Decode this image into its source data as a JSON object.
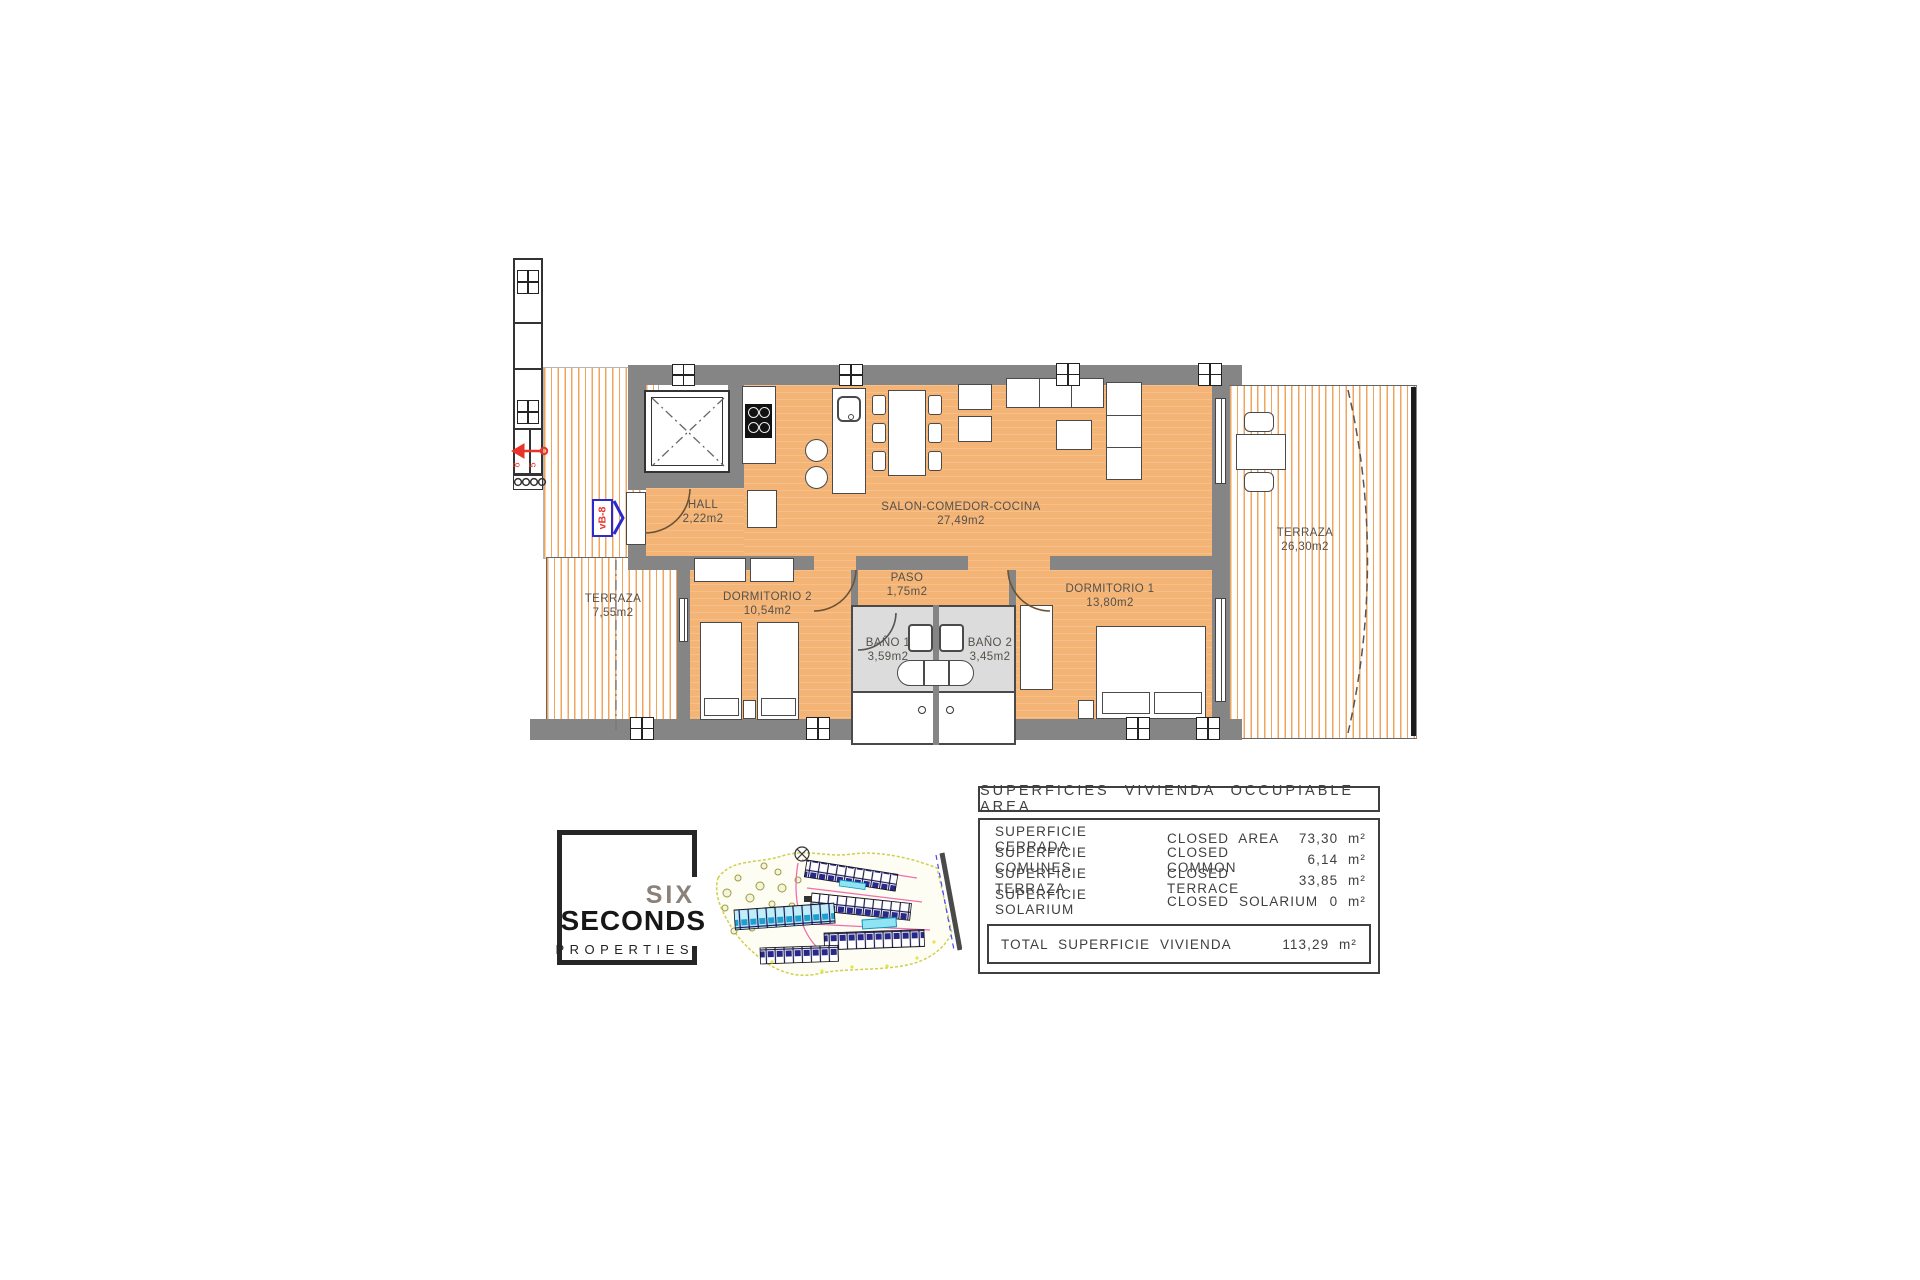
{
  "floor_plan": {
    "unit_label": "vB-8",
    "entrance_marks": {
      "left": "8",
      "right": "5"
    },
    "rooms": {
      "hall": {
        "name": "HALL",
        "area": "2,22m2"
      },
      "salon": {
        "name": "SALON-COMEDOR-COCINA",
        "area": "27,49m2"
      },
      "paso": {
        "name": "PASO",
        "area": "1,75m2"
      },
      "dormitorio2": {
        "name": "DORMITORIO 2",
        "area": "10,54m2"
      },
      "dormitorio1": {
        "name": "DORMITORIO 1",
        "area": "13,80m2"
      },
      "bano1": {
        "name": "BAÑO 1",
        "area": "3,59m2"
      },
      "bano2": {
        "name": "BAÑO 2",
        "area": "3,45m2"
      },
      "terraza_izq": {
        "name": "TERRAZA",
        "area": "7,55m2"
      },
      "terraza_der": {
        "name": "TERRAZA",
        "area": "26,30m2"
      }
    },
    "colors": {
      "floor": "#f4b476",
      "wall": "#858585",
      "bath_floor": "#dcdcdc",
      "terrace_stripe": "#efa55c",
      "annotation_red": "#e8322a",
      "annotation_blue": "#2a2ad0"
    }
  },
  "areas_table": {
    "title": "SUPERFICIES VIVIENDA OCCUPIABLE AREA",
    "rows": [
      {
        "label_es": "SUPERFICIE CERRADA",
        "label_en": "CLOSED AREA",
        "value": "73,30 m²"
      },
      {
        "label_es": "SUPERFICIE COMUNES",
        "label_en": "CLOSED COMMON",
        "value": "6,14 m²"
      },
      {
        "label_es": "SUPERFICIE TERRAZA",
        "label_en": "CLOSED TERRACE",
        "value": "33,85 m²"
      },
      {
        "label_es": "SUPERFICIE SOLARIUM",
        "label_en": "CLOSED SOLARIUM",
        "value": "0 m²"
      }
    ],
    "total": {
      "label": "TOTAL SUPERFICIE VIVIENDA",
      "value": "113,29 m²"
    }
  },
  "logo": {
    "word1": "SIX",
    "word2": "SECONDS",
    "word3": "PROPERTIES"
  }
}
